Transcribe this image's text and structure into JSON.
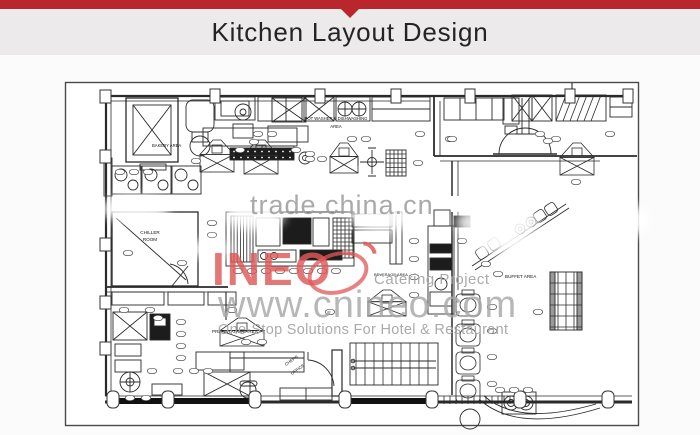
{
  "header": {
    "title": "Kitchen Layout Design"
  },
  "colors": {
    "accent": "#b9262c",
    "band": "#eceaea",
    "page_bg": "#fcfbfb",
    "sheet_border": "#4a4a4a",
    "plan_line": "#2a2a2a",
    "logo_red": "#e05858",
    "watermark_gray": "#a6a6a6",
    "trade_gray": "#979797"
  },
  "plan": {
    "areas": {
      "bakery": "BAKERY AREA",
      "potwash_line1": "POT WASHER & DISHWASHING",
      "potwash_line2": "AREA",
      "chiller_line1": "CHILLER",
      "chiller_line2": "ROOM",
      "preparation": "PREPARATION AREA",
      "chefs_office_line1": "CHEF'S",
      "chefs_office_line2": "OFFICE",
      "beverage": "BEVERAGE AREA",
      "buffet": "BUFFET AREA"
    }
  },
  "watermarks": {
    "trade": "trade.china.cn",
    "logo": "INEO",
    "catering": "Catering Project",
    "site": "www.cnineo.com",
    "tagline": "One-Stop Solutions For Hotel & Restaurant"
  }
}
